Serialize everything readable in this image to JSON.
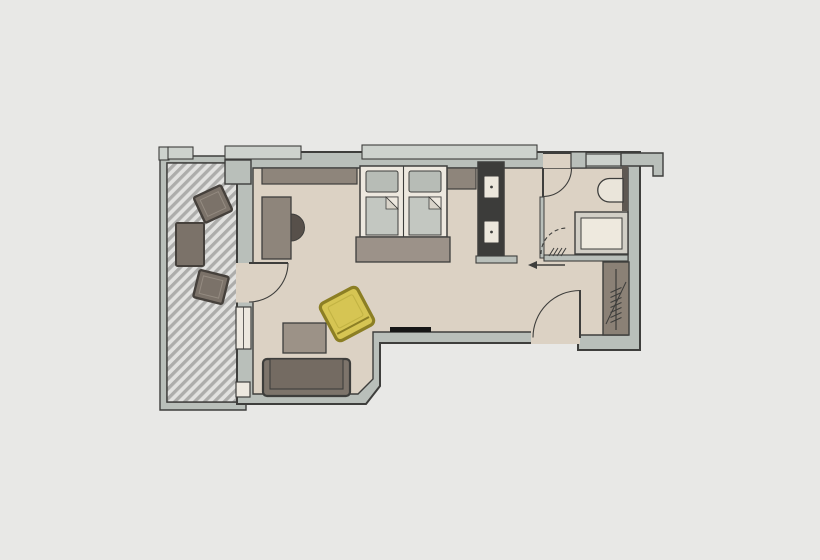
{
  "canvas": {
    "width": 820,
    "height": 560
  },
  "plan": {
    "type": "floor-plan",
    "rooms": [
      "balcony",
      "living-area",
      "sleeping-area",
      "bathroom",
      "entry-hall"
    ],
    "furniture": [
      "balcony-chair",
      "balcony-table",
      "balcony-chair",
      "sideboard",
      "desk",
      "desk-chair",
      "double-bed",
      "bed-runner",
      "closet-minibar",
      "armchair",
      "coffee-table",
      "sofa",
      "tv",
      "toilet",
      "shower",
      "wardrobe"
    ],
    "doors": [
      "balcony-door",
      "bathroom-door",
      "shower-door",
      "entry-door"
    ]
  },
  "palette": {
    "background": "#e8e8e6",
    "outline": "#3e3e3c",
    "wall": "#b9bfba",
    "window_band": "#cdd2cd",
    "floor": "#dcd2c4",
    "hatch_base": "#e2e2e0",
    "hatch_stripe": "#adadab",
    "balcony_furniture": "#7b7269",
    "balcony_furniture_stroke": "#46413c",
    "balcony_furniture_inner": "#948b81",
    "sideboard": "#8e857b",
    "desk_chair": "#57504a",
    "bed_frame": "#ede8df",
    "pillow": "#b7bcb6",
    "mattress": "#c3c7c1",
    "fold_flap": "#d9d4ca",
    "bed_runner": "#9c9289",
    "closet": "#3c3c3a",
    "knob": "#ece7dc",
    "sofa": "#7d746b",
    "sofa_seat": "#746b62",
    "coffee_table": "#9c9287",
    "armchair_yellow": "#d6c553",
    "armchair_stroke": "#8c7f24",
    "armchair_inner": "#c2b343",
    "tv": "#161616",
    "fixture": "#eae5da",
    "shower_frame": "#d2cfc6",
    "shower_tray": "#eee9de",
    "wardrobe": "#8b8176",
    "wall_dark_strip": "#5e5852"
  }
}
